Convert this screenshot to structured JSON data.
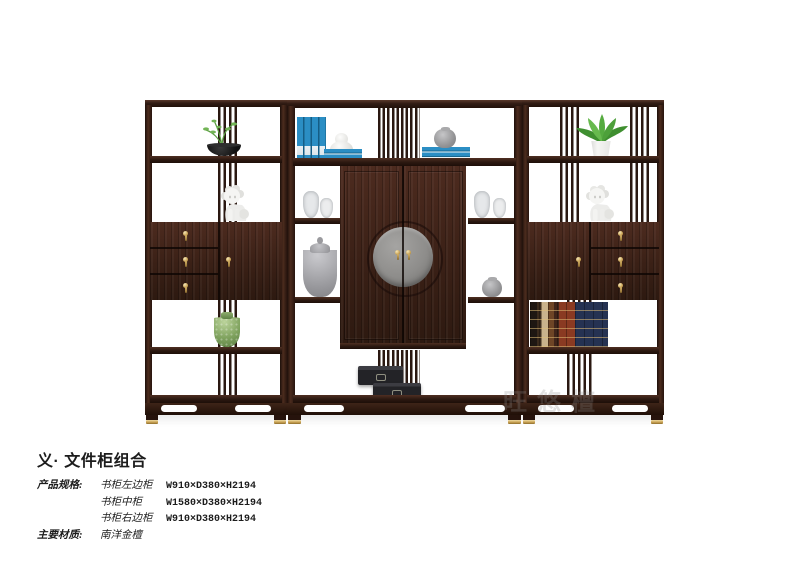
{
  "product": {
    "title": "义· 文件柜组合",
    "specs_label": "产品规格:",
    "specs": [
      {
        "item": "书柜左边柜",
        "dims": "W910×D380×H2194"
      },
      {
        "item": "书柜中柜",
        "dims": "W1580×D380×H2194"
      },
      {
        "item": "书柜右边柜",
        "dims": "W910×D380×H2194"
      }
    ],
    "material_label": "主要材质:",
    "material": "南洋金檀",
    "watermark": "旺悠檀"
  },
  "palette": {
    "wood-dark": "#311d18",
    "wood-mid": "#46281e",
    "brass": "#c9a254",
    "book-blue": "#2b8ec4",
    "medallion": "#8e8d8b",
    "celadon": "#7fa25e",
    "box-black": "#232327"
  }
}
